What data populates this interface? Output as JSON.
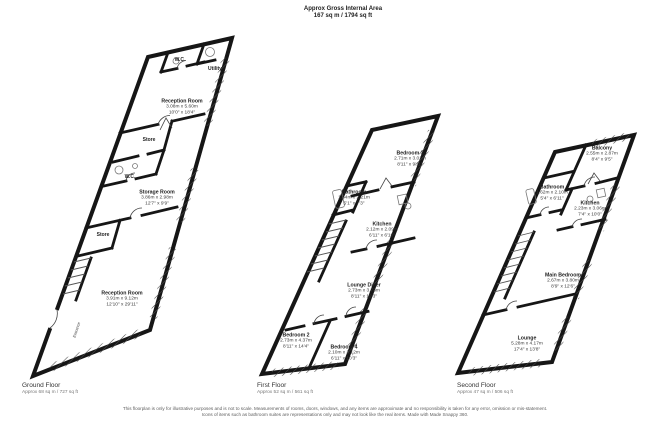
{
  "header": {
    "title": "Approx Gross Internal Area",
    "area": "167 sq m / 1794 sq ft"
  },
  "floors": [
    {
      "name": "Ground Floor",
      "area": "Approx 68 sq m / 727 sq ft",
      "rooms": [
        {
          "name": "W.C."
        },
        {
          "name": "Utility"
        },
        {
          "name": "Reception Room",
          "dims_m": "3.08m x 5.60m",
          "dims_ft": "10'0\" x 18'4\""
        },
        {
          "name": "Store"
        },
        {
          "name": "W.C."
        },
        {
          "name": "Storage Room",
          "dims_m": "3.86m x 2.98m",
          "dims_ft": "12'7\" x 9'9\""
        },
        {
          "name": "Store"
        },
        {
          "name": "Reception Room",
          "dims_m": "3.91m x 9.12m",
          "dims_ft": "12'10\" x 29'11\""
        },
        {
          "name": "Entrance"
        }
      ]
    },
    {
      "name": "First Floor",
      "area": "Approx 52 sq m / 561 sq ft",
      "rooms": [
        {
          "name": "Bedroom 3",
          "dims_m": "2.71m x 3.01m",
          "dims_ft": "8'11\" x 9'11\""
        },
        {
          "name": "Bathroom",
          "dims_m": "1.54m x 2.21m",
          "dims_ft": "5'1\" x 7'3\""
        },
        {
          "name": "Kitchen",
          "dims_m": "2.12m x 2.09m",
          "dims_ft": "6'11\" x 6'10\""
        },
        {
          "name": "Lounge Diner",
          "dims_m": "2.73m x 3.73m",
          "dims_ft": "8'11\" x 12'3\""
        },
        {
          "name": "Bedroom 2",
          "dims_m": "2.73m x 4.37m",
          "dims_ft": "8'11\" x 14'4\""
        },
        {
          "name": "Bedroom 4",
          "dims_m": "2.10m x 3.12m",
          "dims_ft": "6'11\" x 10'3\""
        }
      ]
    },
    {
      "name": "Second Floor",
      "area": "Approx 47 sq m / 506 sq ft",
      "rooms": [
        {
          "name": "Balcony",
          "dims_m": "2.55m x 2.87m",
          "dims_ft": "8'4\" x 9'5\""
        },
        {
          "name": "Bathroom",
          "dims_m": "1.62m x 2.10m",
          "dims_ft": "5'4\" x 6'11\""
        },
        {
          "name": "Kitchen",
          "dims_m": "2.23m x 3.06m",
          "dims_ft": "7'4\" x 10'0\""
        },
        {
          "name": "Main Bedroom",
          "dims_m": "2.67m x 3.80m",
          "dims_ft": "8'9\" x 12'6\""
        },
        {
          "name": "Lounge",
          "dims_m": "5.28m x 4.17m",
          "dims_ft": "17'4\" x 13'8\""
        }
      ]
    }
  ],
  "disclaimer": "This floorplan is only for illustrative purposes and is not to scale. Measurements of rooms, doors, windows, and any items are approximate and no responsibility is taken for any error, omission or mis-statement. Icons of items such as bathroom suites are representations only and may not look like the real items. Made with Made Snappy 360.",
  "colors": {
    "wall": "#161616",
    "hatch": "#4a4a4a",
    "background": "#ffffff"
  }
}
